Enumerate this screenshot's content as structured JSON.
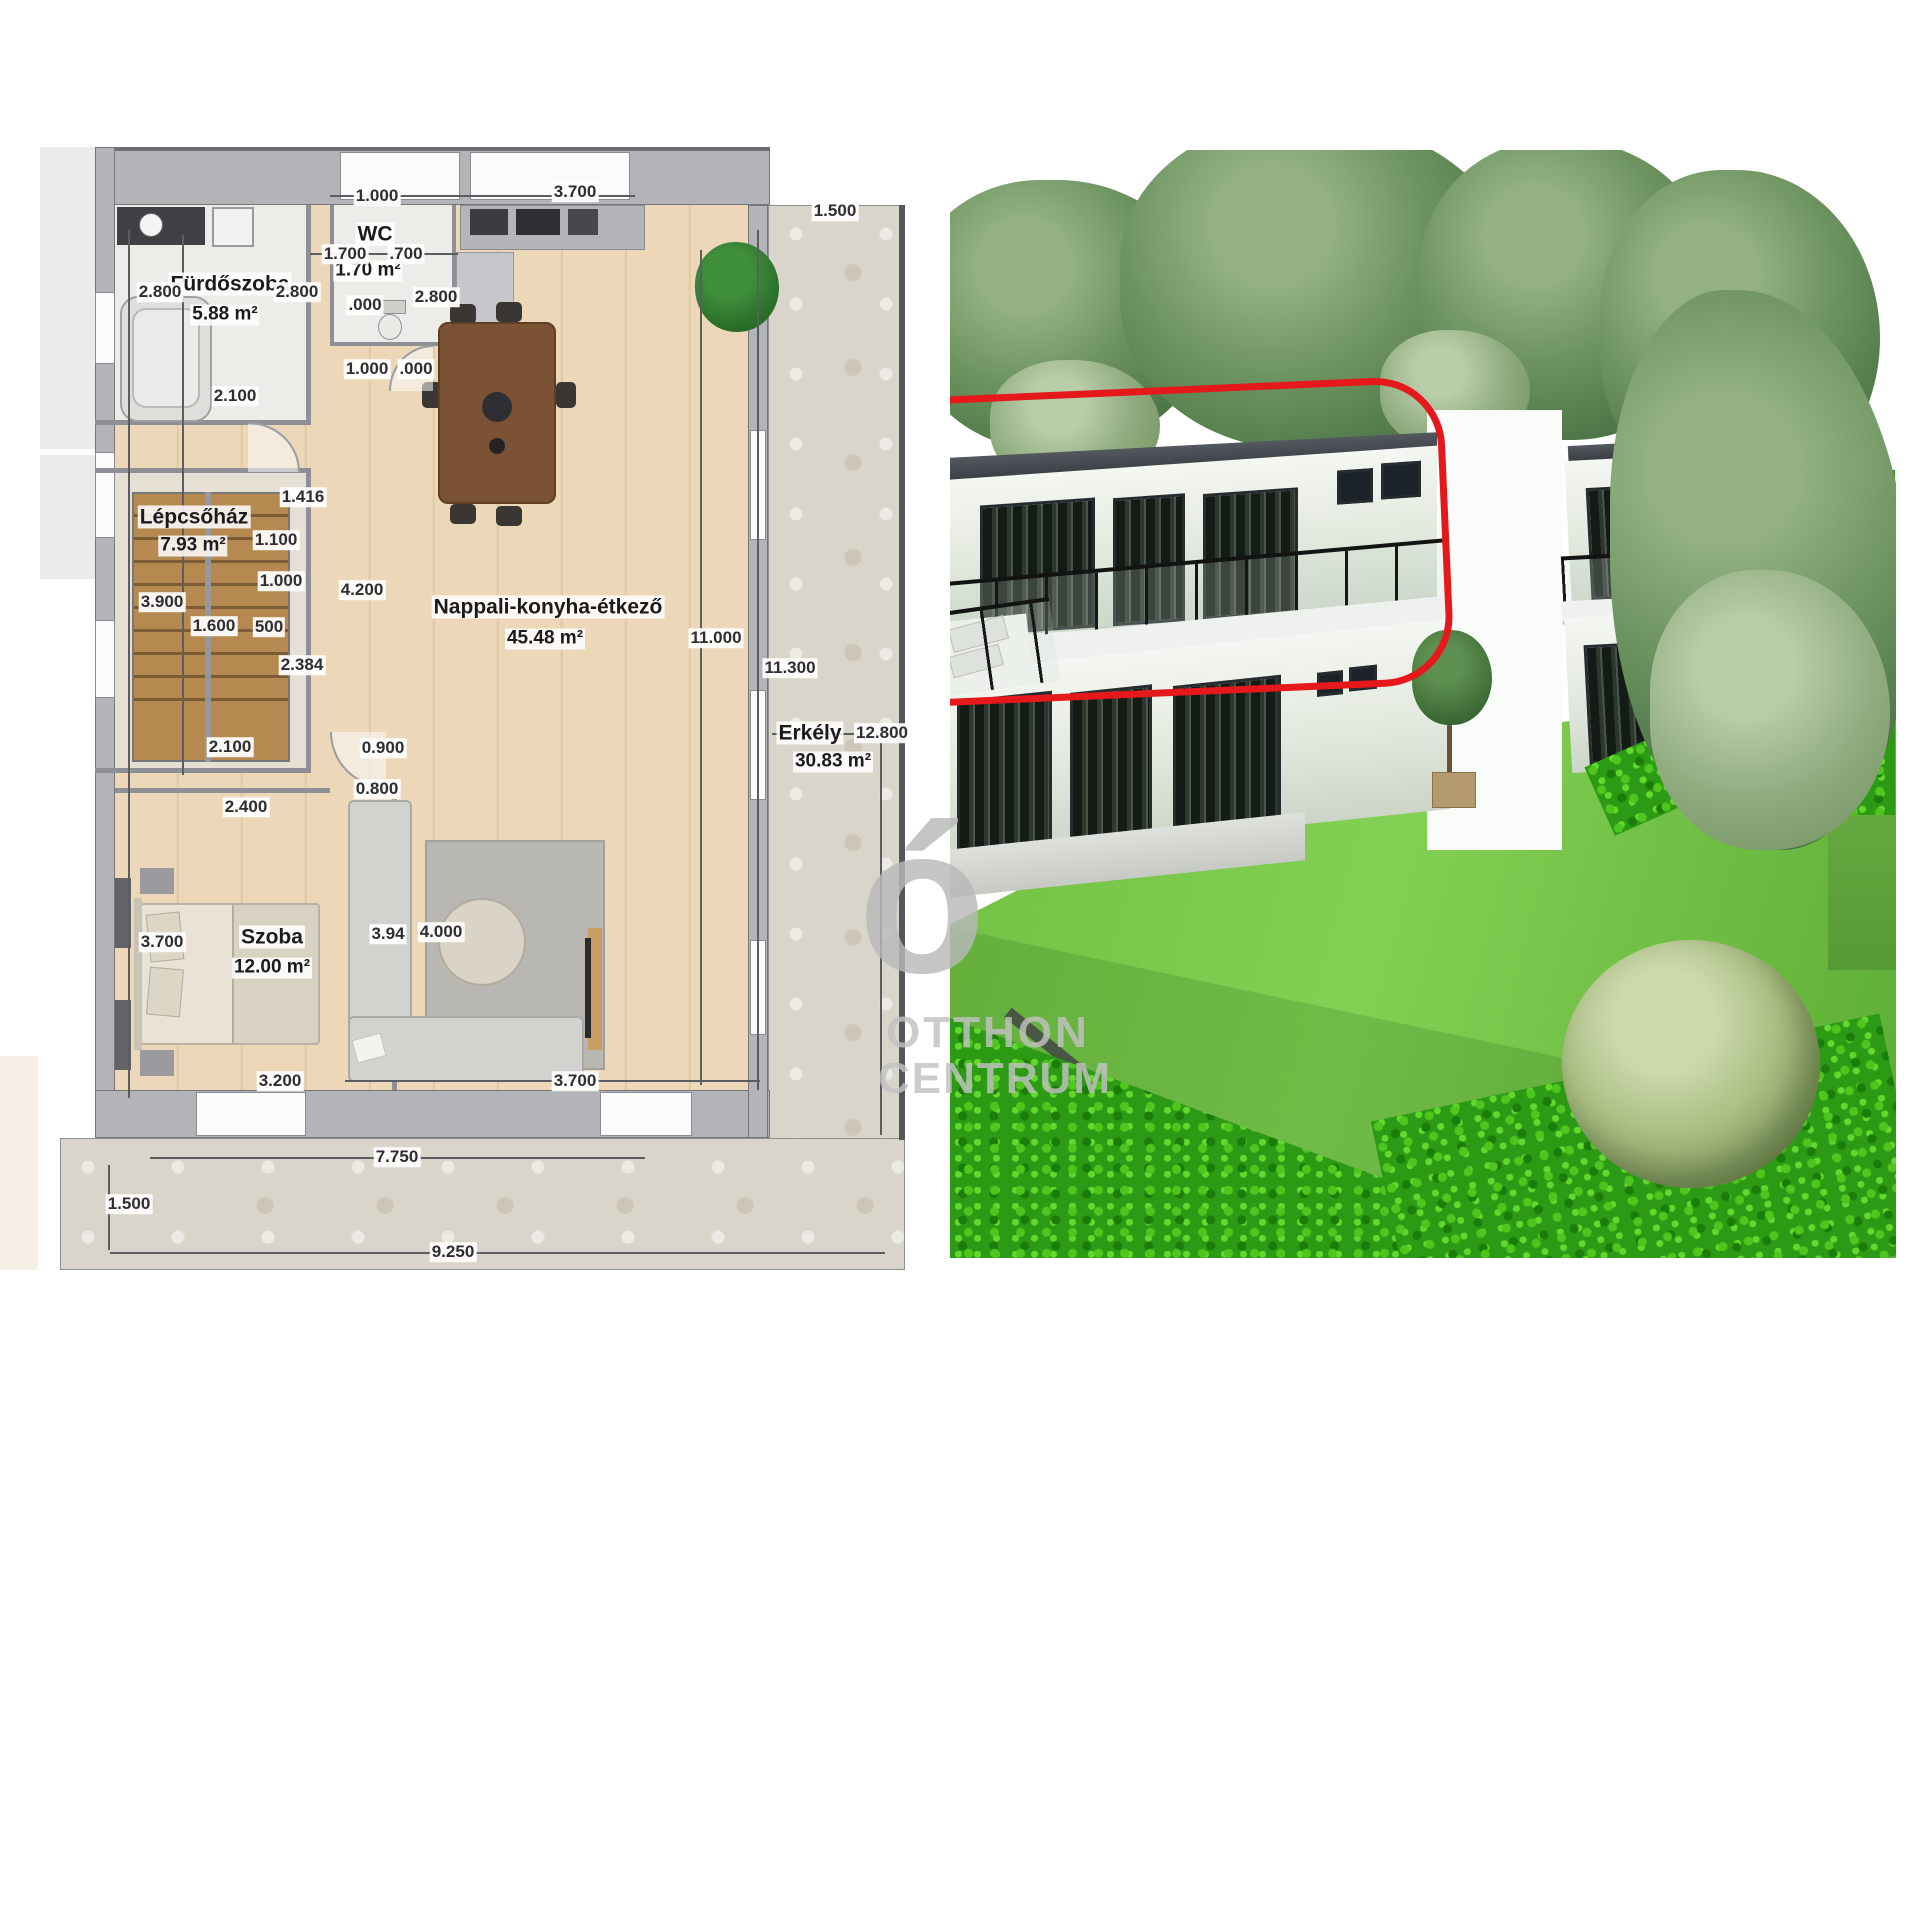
{
  "floor_plan": {
    "rooms": [
      {
        "name": "Fürdőszoba",
        "area": "5.88 m²",
        "nx": 230,
        "ny": 284,
        "ax": 225,
        "ay": 315
      },
      {
        "name": "WC",
        "area": "1.70 m²",
        "nx": 375,
        "ny": 234,
        "ax": 368,
        "ay": 271
      },
      {
        "name": "Lépcsőház",
        "area": "7.93 m²",
        "nx": 194,
        "ny": 517,
        "ax": 193,
        "ay": 546
      },
      {
        "name": "Nappali-konyha-étkező",
        "area": "45.48 m²",
        "nx": 548,
        "ny": 607,
        "ax": 545,
        "ay": 639
      },
      {
        "name": "Szoba",
        "area": "12.00 m²",
        "nx": 272,
        "ny": 937,
        "ax": 272,
        "ay": 968
      },
      {
        "name": "Erkély",
        "area": "30.83 m²",
        "nx": 810,
        "ny": 733,
        "ax": 833,
        "ay": 762
      }
    ],
    "dimensions": [
      {
        "t": "1.000",
        "x": 377,
        "y": 196
      },
      {
        "t": "3.700",
        "x": 575,
        "y": 192
      },
      {
        "t": "1.500",
        "x": 835,
        "y": 211
      },
      {
        "t": "1.700",
        "x": 345,
        "y": 254
      },
      {
        "t": ".700",
        "x": 406,
        "y": 254
      },
      {
        "t": "2.800",
        "x": 160,
        "y": 292
      },
      {
        "t": "2.800",
        "x": 297,
        "y": 292
      },
      {
        "t": "2.800",
        "x": 436,
        "y": 297
      },
      {
        "t": ".000",
        "x": 365,
        "y": 305
      },
      {
        "t": "2.100",
        "x": 235,
        "y": 396
      },
      {
        "t": "1.000",
        "x": 367,
        "y": 369
      },
      {
        "t": ".000",
        "x": 416,
        "y": 369
      },
      {
        "t": "1.416",
        "x": 303,
        "y": 497
      },
      {
        "t": "1.100",
        "x": 276,
        "y": 540
      },
      {
        "t": "1.000",
        "x": 281,
        "y": 581
      },
      {
        "t": "4.200",
        "x": 362,
        "y": 590
      },
      {
        "t": "3.900",
        "x": 162,
        "y": 602
      },
      {
        "t": "1.600",
        "x": 214,
        "y": 626
      },
      {
        "t": "500",
        "x": 269,
        "y": 627
      },
      {
        "t": "2.384",
        "x": 302,
        "y": 665
      },
      {
        "t": "2.100",
        "x": 230,
        "y": 747
      },
      {
        "t": "0.900",
        "x": 383,
        "y": 748
      },
      {
        "t": "0.800",
        "x": 377,
        "y": 789
      },
      {
        "t": "2.400",
        "x": 246,
        "y": 807
      },
      {
        "t": "3.700",
        "x": 162,
        "y": 942
      },
      {
        "t": "3.94",
        "x": 388,
        "y": 934
      },
      {
        "t": "4.000",
        "x": 441,
        "y": 932
      },
      {
        "t": "3.200",
        "x": 280,
        "y": 1081
      },
      {
        "t": "3.700",
        "x": 575,
        "y": 1081
      },
      {
        "t": "11.000",
        "x": 716,
        "y": 638
      },
      {
        "t": "11.300",
        "x": 790,
        "y": 668
      },
      {
        "t": "12.800",
        "x": 882,
        "y": 733
      },
      {
        "t": "7.750",
        "x": 397,
        "y": 1157
      },
      {
        "t": "1.500",
        "x": 129,
        "y": 1204
      },
      {
        "t": "9.250",
        "x": 453,
        "y": 1252
      }
    ]
  },
  "photo": {
    "highlight_color": "#e5181b"
  },
  "watermark": {
    "glyph": "ó",
    "line1": "OTTHON",
    "line2": "CENTRUM",
    "color": "#b9b9b9"
  }
}
